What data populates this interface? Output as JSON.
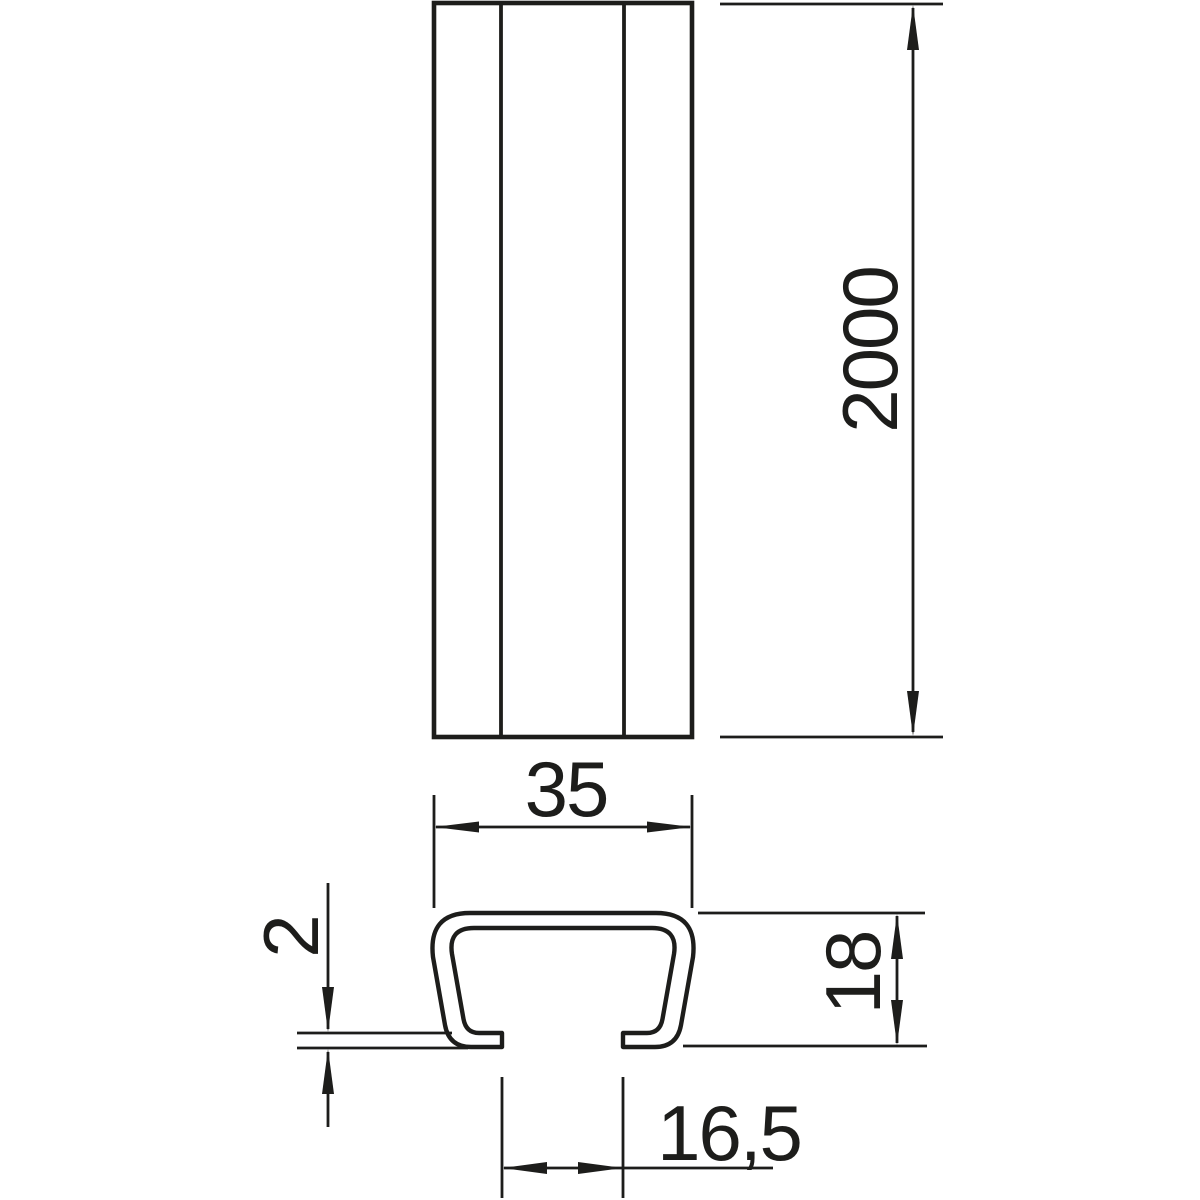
{
  "drawing": {
    "kind": "technical-dimension-drawing",
    "views": [
      "rail-front-view",
      "rail-cross-section"
    ]
  },
  "colors": {
    "line": "#1d1d1b",
    "background": "#ffffff"
  },
  "dimensions": {
    "length": {
      "value": "2000"
    },
    "width": {
      "value": "35"
    },
    "profile_height": {
      "value": "18"
    },
    "material_thickness": {
      "value": "2"
    },
    "slot_width": {
      "value": "16,5"
    }
  }
}
